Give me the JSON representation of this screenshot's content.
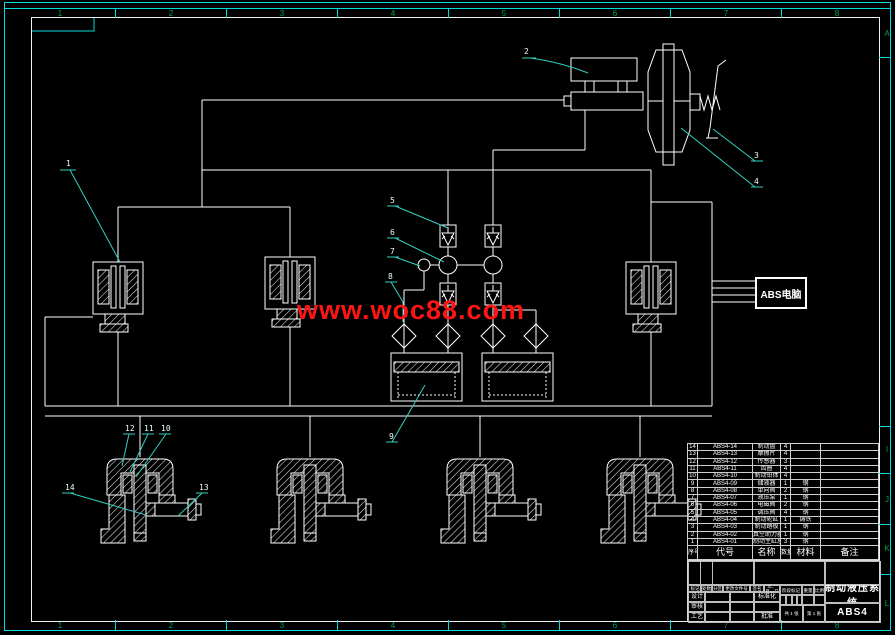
{
  "watermark": "www.woc88.com",
  "abs_box": {
    "label": "ABS电脑"
  },
  "zones": {
    "top": [
      "1",
      "2",
      "3",
      "4",
      "5",
      "6",
      "7",
      "8"
    ],
    "bottom": [
      "1",
      "2",
      "3",
      "4",
      "5",
      "6",
      "7",
      "8"
    ],
    "right_letters": [
      "A",
      "I",
      "J",
      "K",
      "L"
    ]
  },
  "callouts": {
    "c1": "1",
    "c2": "2",
    "c3": "3",
    "c4": "4",
    "c5": "5",
    "c6": "6",
    "c7": "7",
    "c8": "8",
    "c9": "9",
    "c10": "10",
    "c11": "11",
    "c12": "12",
    "c13": "13",
    "c14": "14"
  },
  "parts_table": {
    "headers": [
      "序号",
      "代号",
      "名称",
      "数量",
      "材料",
      "备注"
    ],
    "rows": [
      {
        "no": "14",
        "code": "ABS4-14",
        "name": "制动盘",
        "qty": "4",
        "mat": "",
        "note": ""
      },
      {
        "no": "13",
        "code": "ABS4-13",
        "name": "摩擦片",
        "qty": "4",
        "mat": "",
        "note": ""
      },
      {
        "no": "12",
        "code": "ABS4-12",
        "name": "传感器",
        "qty": "3",
        "mat": "",
        "note": ""
      },
      {
        "no": "11",
        "code": "ABS4-11",
        "name": "齿圈",
        "qty": "4",
        "mat": "",
        "note": ""
      },
      {
        "no": "10",
        "code": "ABS4-10",
        "name": "制动钳体",
        "qty": "4",
        "mat": "",
        "note": ""
      },
      {
        "no": "9",
        "code": "ABS4-09",
        "name": "储液器",
        "qty": "1",
        "mat": "钢",
        "note": ""
      },
      {
        "no": "8",
        "code": "ABS4-08",
        "name": "单向阀",
        "qty": "2",
        "mat": "钢",
        "note": ""
      },
      {
        "no": "7",
        "code": "ABS4-07",
        "name": "液压泵",
        "qty": "1",
        "mat": "钢",
        "note": ""
      },
      {
        "no": "6",
        "code": "ABS4-06",
        "name": "电磁阀",
        "qty": "2",
        "mat": "钢",
        "note": ""
      },
      {
        "no": "5",
        "code": "ABS4-05",
        "name": "调压阀",
        "qty": "4",
        "mat": "钢",
        "note": ""
      },
      {
        "no": "4",
        "code": "ABS4-04",
        "name": "制动轮缸",
        "qty": "1",
        "mat": "铸铁",
        "note": ""
      },
      {
        "no": "3",
        "code": "ABS4-03",
        "name": "制动踏板",
        "qty": "1",
        "mat": "钢",
        "note": ""
      },
      {
        "no": "2",
        "code": "ABS4-02",
        "name": "真空助力器",
        "qty": "1",
        "mat": "钢",
        "note": ""
      },
      {
        "no": "1",
        "code": "ABS4-01",
        "name": "制动主缸总成",
        "qty": "3",
        "mat": "钢",
        "note": ""
      }
    ]
  },
  "title_block": {
    "revision_header": [
      "标记",
      "处数",
      "分区",
      "更改文件号",
      "签名",
      "年、月、日"
    ],
    "design_label": "设计",
    "check_label": "审核",
    "process_label": "工艺",
    "standard_label": "标准化",
    "approve_label": "批准",
    "stage_label": "阶段标记",
    "weight_label": "重量",
    "scale_label": "比例",
    "sheet_total": "共 1 张",
    "sheet_no": "第 1 张",
    "title": "制动液压系统",
    "drawing_no": "ABS4"
  }
}
